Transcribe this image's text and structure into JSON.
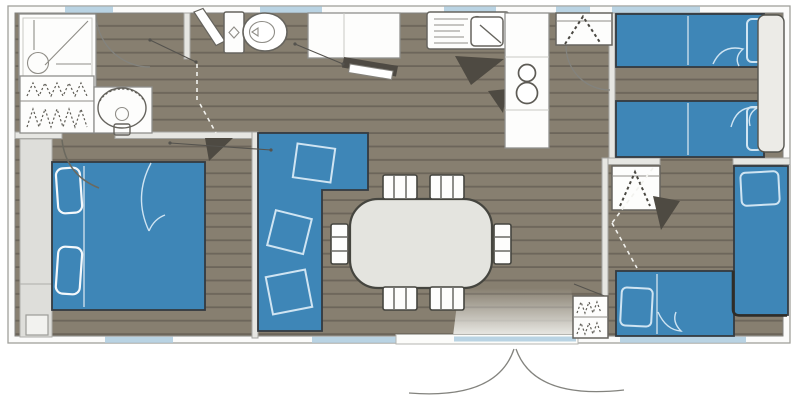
{
  "plan": {
    "title": "mobile-home-floor-plan",
    "colors": {
      "bg": "#ffffff",
      "floor": "#877f70",
      "floor_line": "#6c655a",
      "wall_fill": "#fbfbfa",
      "wall_stroke": "#a0a09c",
      "partition": "#e6e6e2",
      "white_fixture": "#fdfdfc",
      "fixture_stroke": "#66645e",
      "blue": "#3e86b7",
      "blue_line": "#cfe4f2",
      "window": "#b9d3e3",
      "table": "#e4e4df",
      "dark_wedge": "#4e4a42",
      "swing_dash": "#f2f2ee"
    },
    "rooms": [
      {
        "id": "bathroom",
        "fixtures": [
          "shower",
          "storage-shelves",
          "washbasin"
        ]
      },
      {
        "id": "wc",
        "fixtures": [
          "toilet"
        ]
      },
      {
        "id": "kitchen",
        "fixtures": [
          "counter",
          "dishwasher-door",
          "sink-drainer-unit",
          "hob-2-burners",
          "tall-counter"
        ]
      },
      {
        "id": "living-dining",
        "fixtures": [
          "corner-sofa",
          "dining-table",
          "chairs"
        ]
      },
      {
        "id": "bedroom-master",
        "fixtures": [
          "double-bed",
          "wardrobe-band",
          "nightstand"
        ]
      },
      {
        "id": "bedroom-twin",
        "fixtures": [
          "wardrobe",
          "single-bed",
          "single-bed",
          "headboard-shelf"
        ]
      },
      {
        "id": "bedroom-corner",
        "fixtures": [
          "wardrobe",
          "corner-bed-vertical",
          "corner-bed-horizontal",
          "closet"
        ]
      },
      {
        "id": "entrance",
        "fixtures": [
          "double-door-swing",
          "threshold",
          "light-wedge"
        ]
      }
    ],
    "counts": {
      "chairs": 6,
      "bed-places": 5,
      "sofa-cushions": 3,
      "windows-top": 5,
      "windows-bottom": 3
    }
  }
}
